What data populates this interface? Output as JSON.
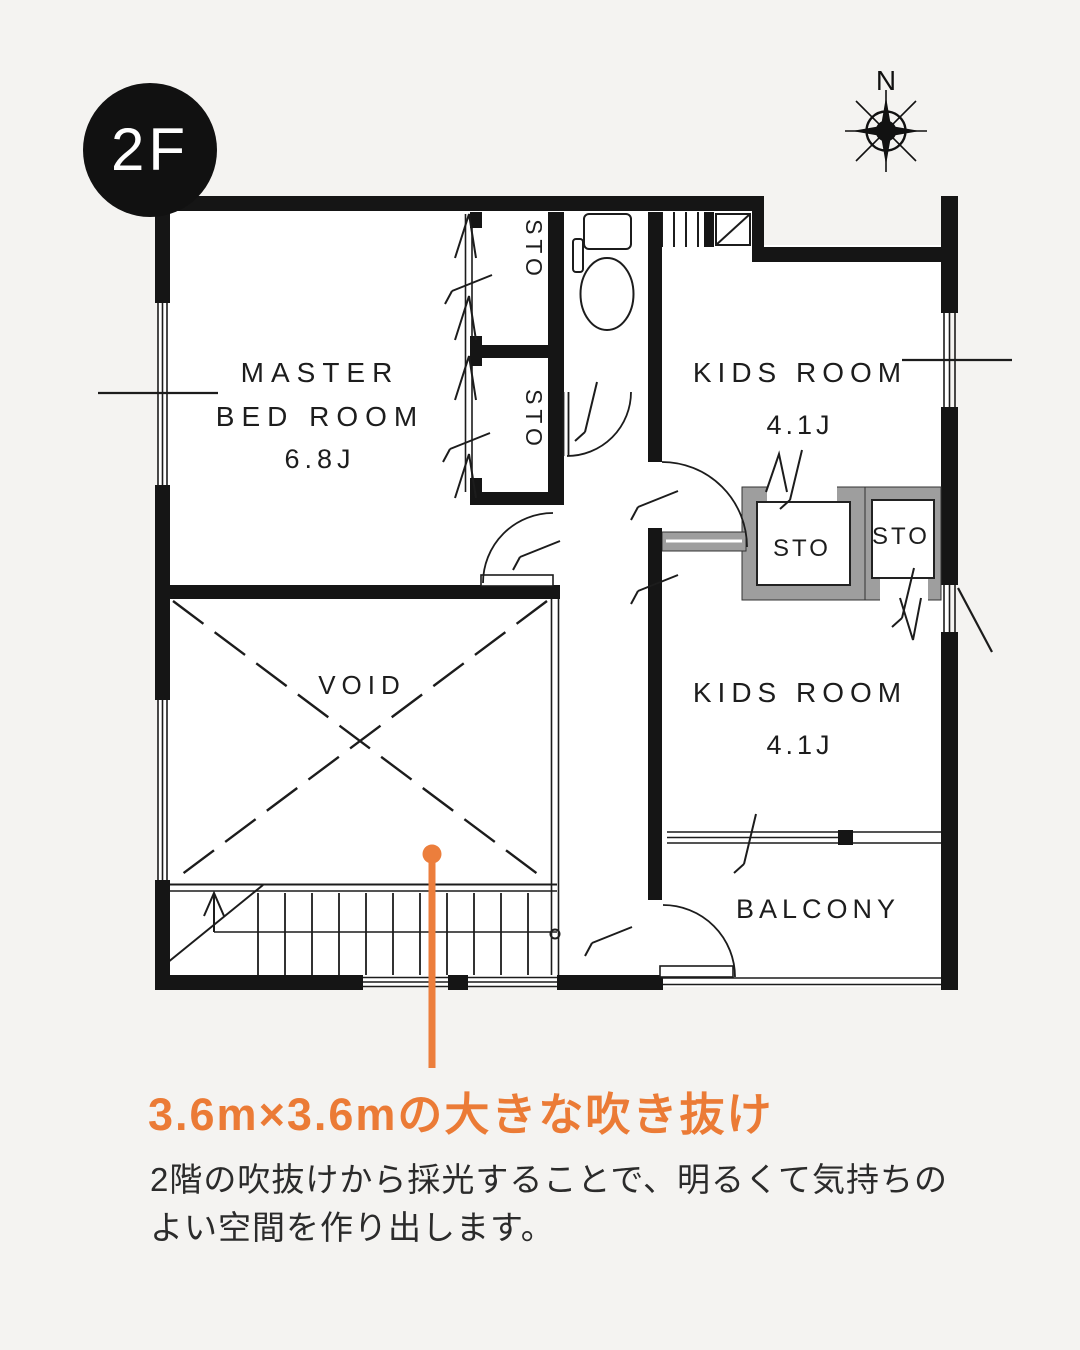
{
  "badge": {
    "label": "2F"
  },
  "compass": {
    "label": "N"
  },
  "plan": {
    "rooms": {
      "master": {
        "line1": "MASTER",
        "line2": "BED ROOM",
        "size": "6.8J"
      },
      "kids1": {
        "name": "KIDS ROOM",
        "size": "4.1J"
      },
      "kids2": {
        "name": "KIDS ROOM",
        "size": "4.1J"
      },
      "void_label": "VOID",
      "balcony": "BALCONY",
      "storage": "STO"
    }
  },
  "callout": {
    "heading": "3.6m×3.6mの大きな吹き抜け",
    "body_line1": "2階の吹抜けから採光することで、明るくて気持ちの",
    "body_line2": "よい空間を作り出します。",
    "accent": "#EC7E3C"
  },
  "colors": {
    "wall": "#151515",
    "gray_wall": "#9e9e9e",
    "background": "#f4f3f1"
  }
}
